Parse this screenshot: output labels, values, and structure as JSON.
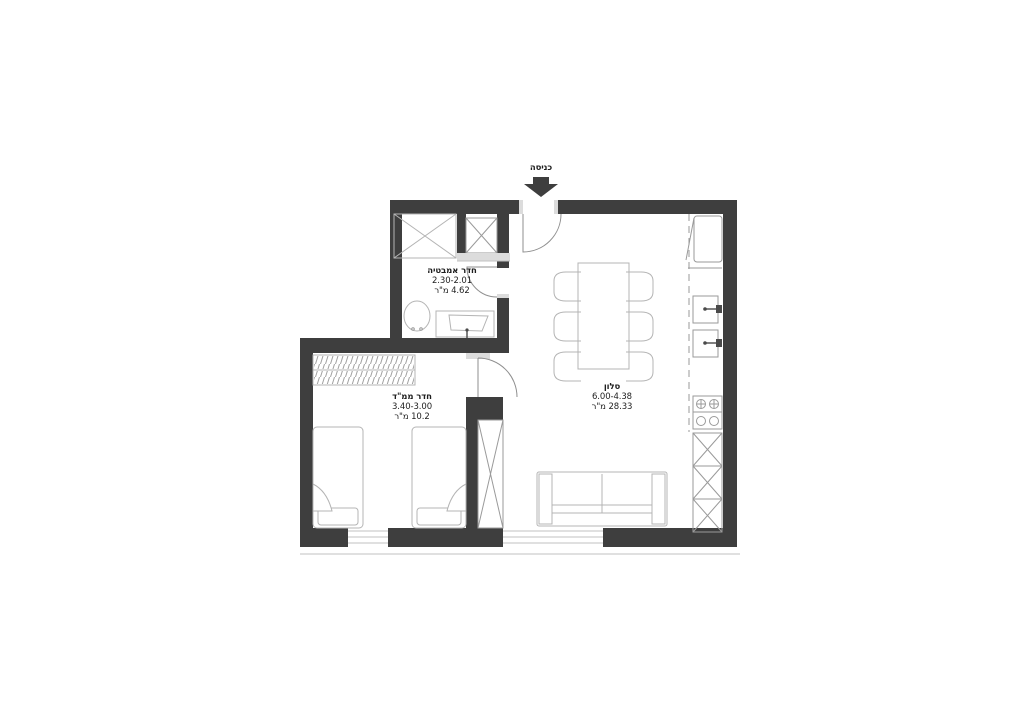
{
  "labels": {
    "entrance": "כניסה"
  },
  "rooms": [
    {
      "id": "bathroom",
      "name": "חדר אמבטיה",
      "dims": "2.30-2.01",
      "area": "4.62 מ\"ר"
    },
    {
      "id": "safe-room",
      "name": "חדר ממ\"ד",
      "dims": "3.40-3.00",
      "area": "10.2 מ\"ר"
    },
    {
      "id": "living-room",
      "name": "סלון",
      "dims": "6.00-4.38",
      "area": "28.33 מ\"ר"
    }
  ],
  "colors": {
    "wall": "#3e3e3e",
    "line": "#b4b4b4",
    "line2": "#9a9a9a",
    "door": "#8f8f8f",
    "sill": "#c2c2c2",
    "sillfill": "#dcdcdc",
    "ink": "#1e1e1e"
  }
}
